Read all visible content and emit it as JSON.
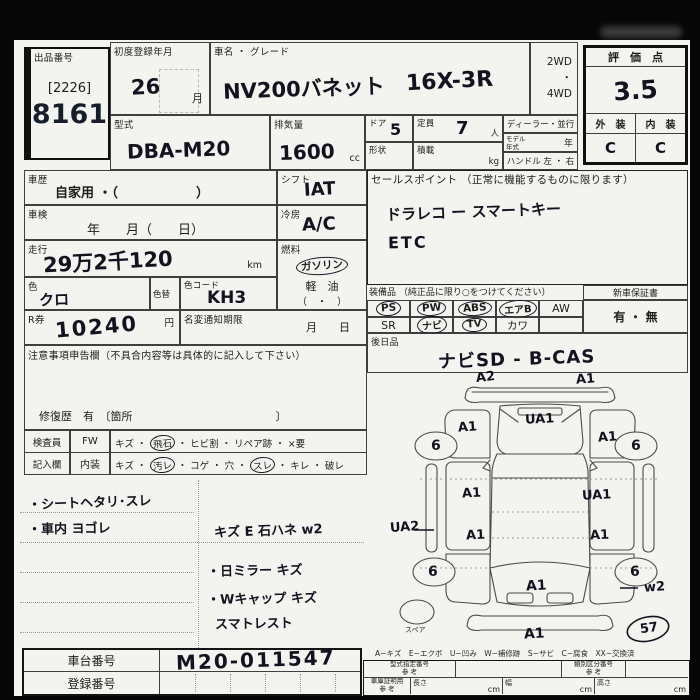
{
  "header": {
    "auction_label": "出品番号",
    "auction_bracket": "[2226]",
    "auction_no": "8161",
    "first_reg_label": "初度登録年月",
    "first_reg_value": "26",
    "month": "月",
    "name_label": "車名 ・ グレード",
    "name_value": "NV200バネット",
    "grade_value": "16X-3R",
    "model_label": "型式",
    "model_value": "DBA-M20",
    "disp_label": "排気量",
    "disp_value": "1600",
    "disp_unit": "cc",
    "door_label": "ドア",
    "door_value": "5",
    "cap_label": "定員",
    "cap_value": "7",
    "cap_unit": "人",
    "shape_label": "形状",
    "load_label": "積載",
    "load_unit": "kg",
    "drive": "2WD\n・\n4WD",
    "dealer_label": "ディーラー・並行",
    "modelyear_label": "モデル\n年式",
    "year_suffix": "年",
    "handle_label": "ハンドル 左 ・ 右"
  },
  "score": {
    "label": "評　価　点",
    "value": "3.5",
    "ext_label": "外　装",
    "int_label": "内　装",
    "ext": "C",
    "int": "C"
  },
  "left": {
    "history_label": "車歴",
    "history_value": "自家用 ・（　　　　　　）",
    "syaken_label": "車検",
    "syaken_value": "年　　月（　　日）",
    "mileage_label": "走行",
    "mileage_value": "29万2千120",
    "km": "km",
    "color_label": "色",
    "color_value": "クロ",
    "colorchg_label": "色替",
    "colorcode_label": "色コード",
    "colorcode_value": "KH3",
    "shift_label": "シフト",
    "shift_value": "IAT",
    "ac_label": "冷房",
    "ac_value": "A/C",
    "fuel_label": "燃料",
    "fuel_gas": "ガソリン",
    "fuel_diesel": "軽　油",
    "fuel_other": "（　・　）",
    "r_label": "R券",
    "r_value": "10240",
    "yen": "円",
    "meihen_label": "名変通知期限",
    "meihen_value": "月　　日",
    "notice_label": "注意事項申告欄（不具合内容等は具体的に記入して下さい）",
    "repair_line": "修復歴　有　〔箇所　　　　　　　　　　　　　〕",
    "insp_head1": "検査員",
    "insp_head2": "記入欄",
    "fw_label": "FW",
    "fw_pre": "キズ ・",
    "fw_circ": "飛石",
    "fw_post": "・ ヒビ割 ・ リペア跡 ・ ×要",
    "int_label": "内装",
    "int_pre": "キズ ・",
    "int_c1": "汚レ",
    "int_m": "・ コゲ ・ 穴 ・",
    "int_c2": "スレ",
    "int_post": "・ キレ ・ 破レ"
  },
  "sales": {
    "label": "セールスポイント （正常に機能するものに限ります）",
    "line1": "ドラレコ ー スマートキー",
    "line2": "ETC"
  },
  "equip": {
    "label": "装備品 （純正品に限り○をつけてください）",
    "r1": [
      "PS",
      "PW",
      "ABS",
      "エアB",
      "AW"
    ],
    "r2": [
      "SR",
      "ナビ",
      "TV",
      "カワ",
      ""
    ],
    "warranty_label": "新車保証書",
    "warranty_value": "有 ・ 無",
    "later_label": "後日品",
    "later_value": "ナビSD - B-CAS"
  },
  "notes": [
    "・シートヘタリ･スレ",
    "・車内 ヨゴレ",
    "キズ E 石ハネ w2",
    "・日ミラー キズ",
    "・Wキャップ キズ",
    "スマトレスト"
  ],
  "diagram": {
    "marks": [
      "A2",
      "A1",
      "UA1",
      "A1",
      "A1",
      "6",
      "6",
      "A1",
      "UA1",
      "A1",
      "A1",
      "UA2",
      "6",
      "6",
      "w2",
      "A1",
      "A1",
      "57"
    ],
    "spare": "スペア",
    "legend": "A−キズ　E−エクボ　U−凹み　W−補修跡　S−サビ　C−腐食　XX−交換済"
  },
  "bottom": {
    "chassis_label": "車台番号",
    "chassis_value": "M20-011547",
    "reg_label": "登録番号",
    "katashiki_label": "型式指定番号\n参 考",
    "ruibetsu_label": "類別区分番号\n参 考",
    "syako_label": "車庫証明用\n参 考",
    "len_label": "長さ",
    "wid_label": "幅",
    "hei_label": "高さ",
    "cm": "cm"
  }
}
